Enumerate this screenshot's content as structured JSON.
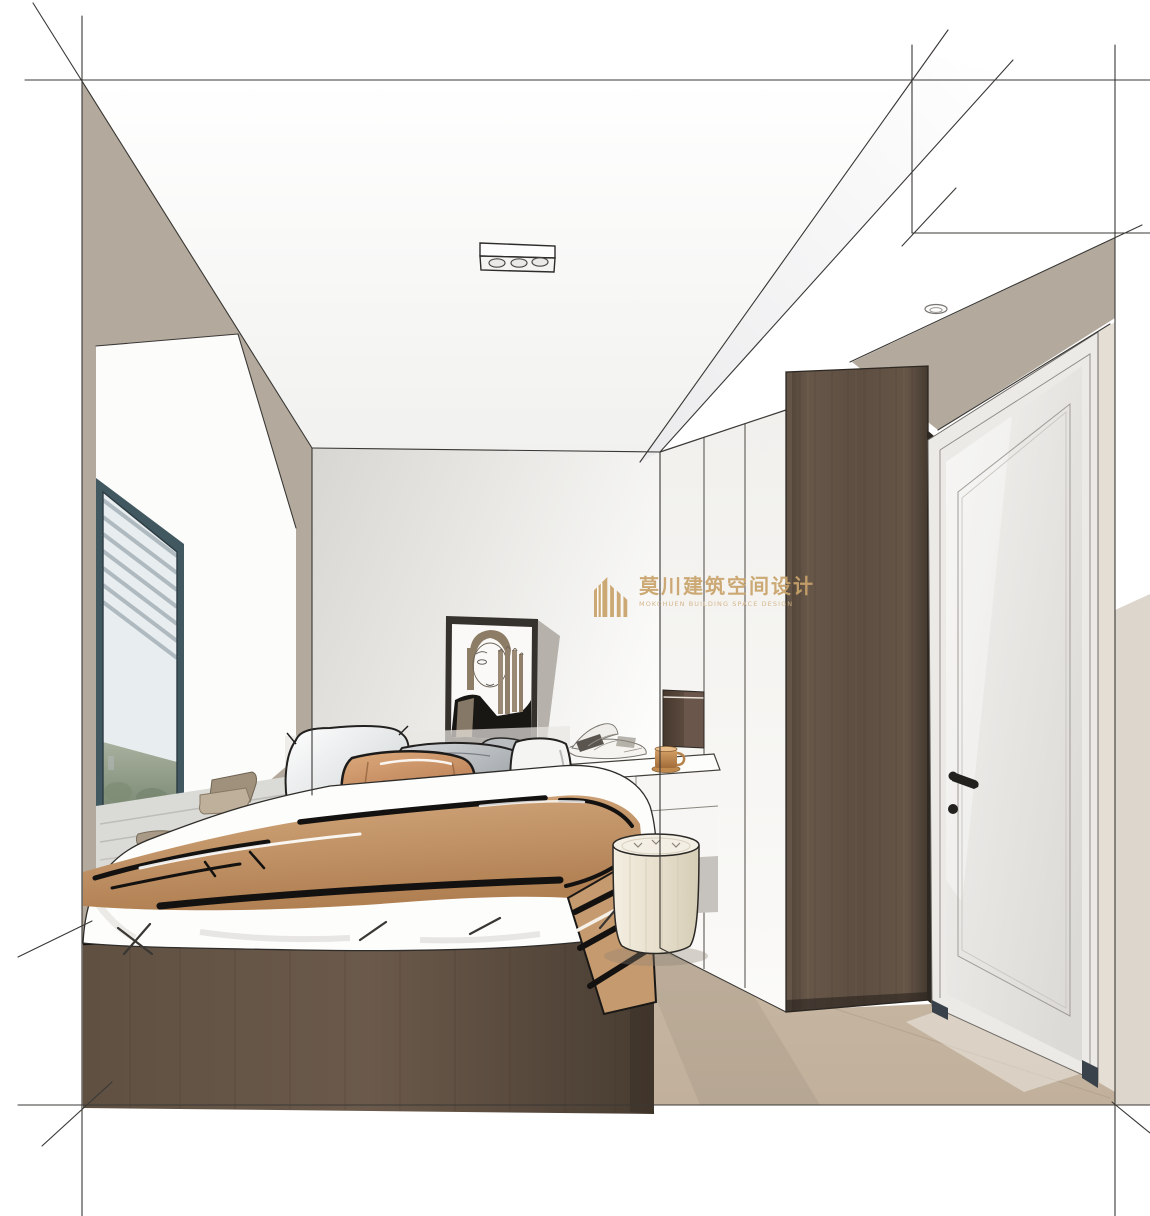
{
  "image": {
    "kind": "interior-design-rendering",
    "subject": "bedroom one-point perspective sketch render"
  },
  "watermark": {
    "logo_text": "莫川建筑空间设计",
    "logo_subtext": "MOKCHUEN BUILDING SPACE DESIGN",
    "brand_color": "#c9a36a"
  },
  "palette": {
    "brand_gold": "#c9a36a",
    "wall_taupe": "#b3aa9d",
    "back_wall_shadow": "#d7d6d2",
    "floor_wood": "#c8b7a3",
    "dark_wood": "#57483c",
    "bed_platform": "#5d4d3f",
    "blanket_tan": "#c59a6e",
    "pillow_orange": "#c98f62",
    "pillow_gray": "#9aa0a4",
    "pouf_cream": "#eee8d8",
    "window_frame_teal": "#3f565e",
    "greenery": "#8d9a85",
    "sketch_line": "#3a3835"
  },
  "scene": {
    "room": "bedroom",
    "objects": [
      "construction-sketch-lines",
      "ceiling-track-light",
      "recessed-spotlight",
      "window-bay-with-blinds",
      "window-seat-with-pillows",
      "platform-bed",
      "gray-pillows",
      "orange-accent-pillow",
      "tan-throw-blanket",
      "leaning-line-art-portrait",
      "vanity-desk",
      "open-magazine",
      "wooden-cup",
      "cream-pouf",
      "white-wardrobe-panels",
      "dark-wood-cabinet",
      "white-panel-door-with-black-handle",
      "wood-floor"
    ]
  }
}
